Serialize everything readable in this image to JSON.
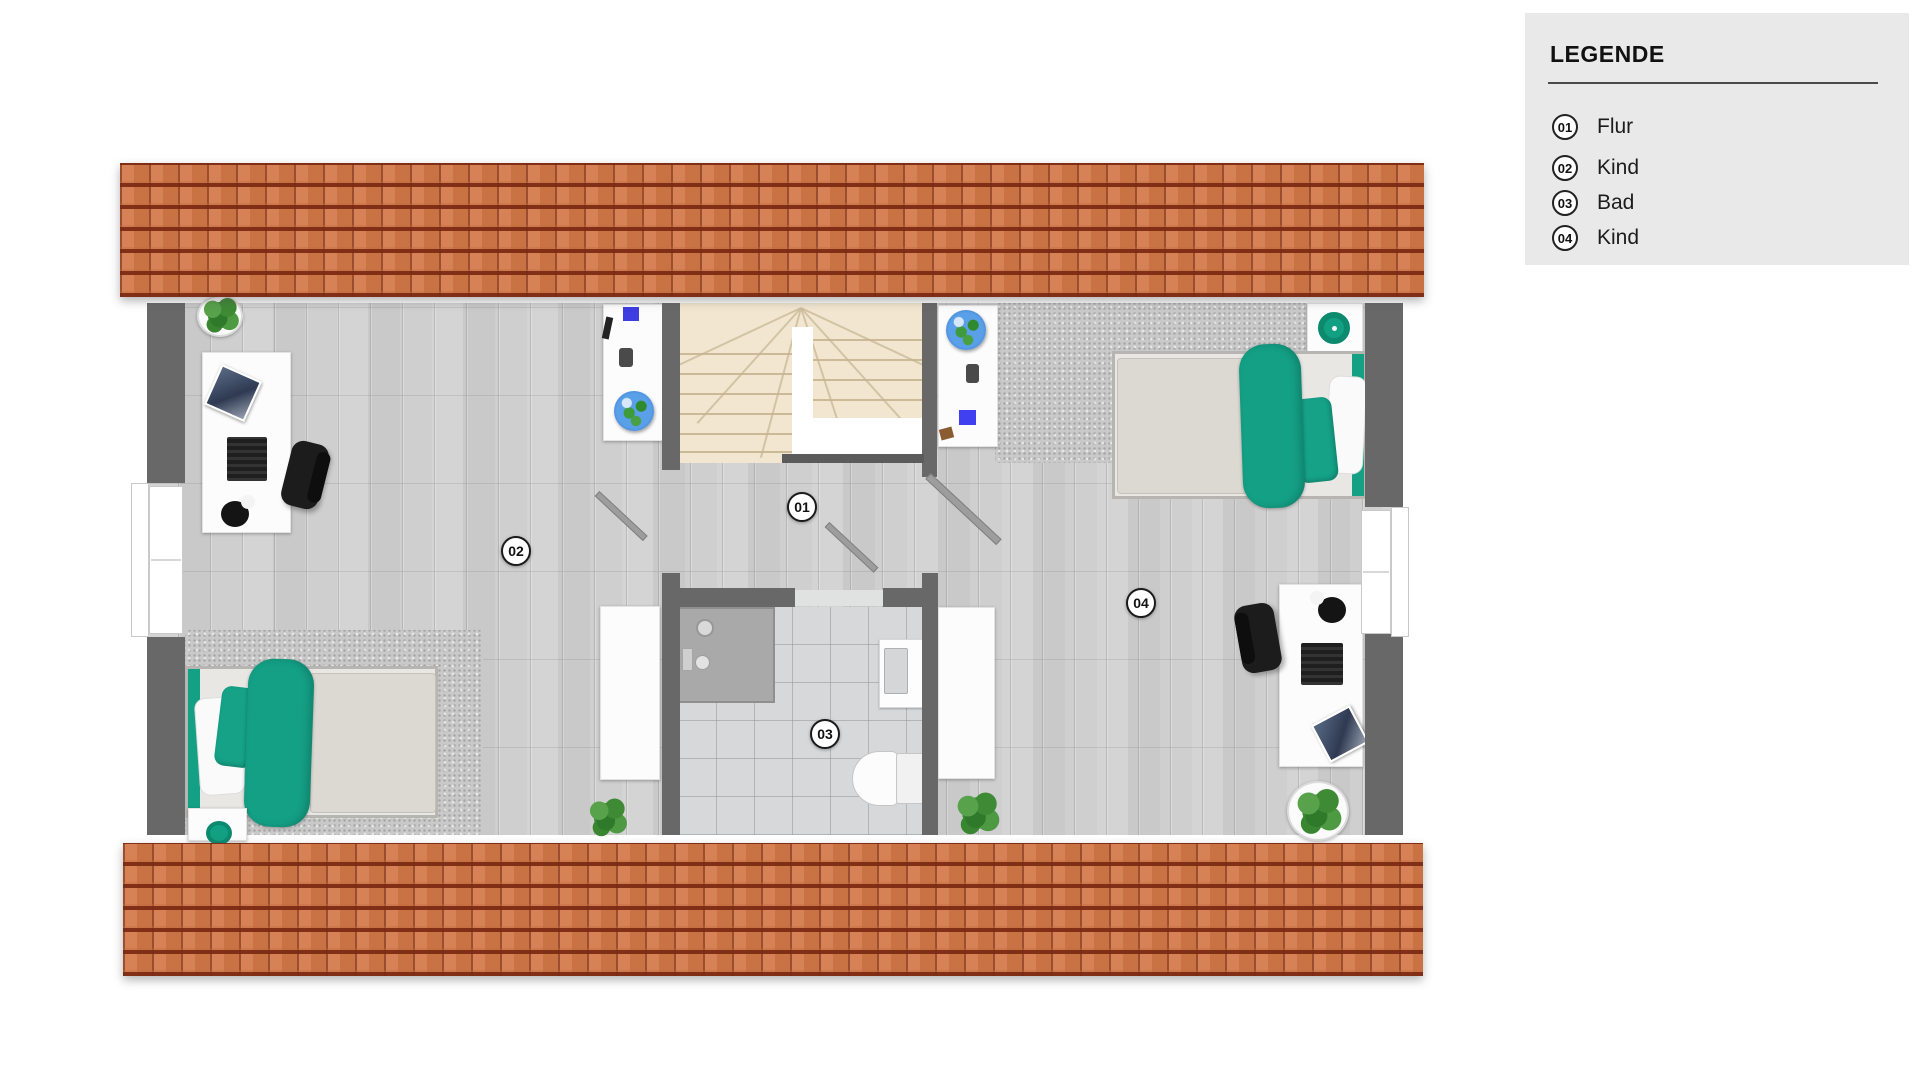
{
  "legend": {
    "title": "LEGENDE",
    "items": [
      {
        "number": "01",
        "label": "Flur"
      },
      {
        "number": "02",
        "label": "Kind"
      },
      {
        "number": "03",
        "label": "Bad"
      },
      {
        "number": "04",
        "label": "Kind"
      }
    ]
  },
  "floorplan": {
    "markers": [
      {
        "number": "01",
        "room": "Flur"
      },
      {
        "number": "02",
        "room": "Kind"
      },
      {
        "number": "03",
        "room": "Bad"
      },
      {
        "number": "04",
        "room": "Kind"
      }
    ],
    "colors": {
      "accent_teal": "#14a085",
      "roof_tile": "#ce7a4c",
      "wall": "#686868",
      "floor": "#cfcfcf",
      "stairs": "#f2e6d1",
      "bath_tile": "#d6d8da",
      "legend_background": "#e9e9e9"
    }
  }
}
